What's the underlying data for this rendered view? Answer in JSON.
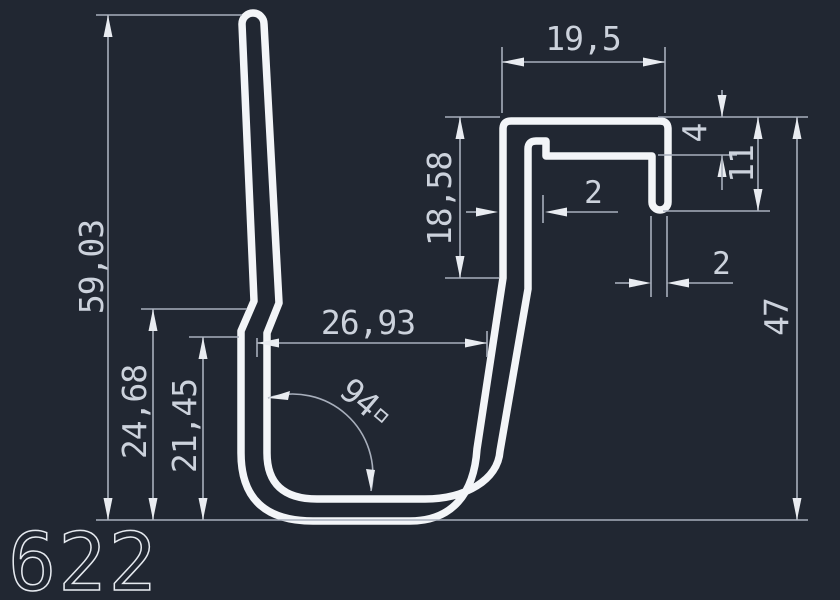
{
  "drawing": {
    "part_label": "622",
    "type": "profile-cross-section"
  },
  "colors": {
    "background": "#212732",
    "profile_stroke": "#f3f5f8",
    "dimension_lines": "#a8afbc",
    "dimension_text": "#ccd2dc",
    "arrowheads": "#e9ecf1"
  },
  "dimensions": {
    "total_height": "59,03",
    "outer_step_height": "24,68",
    "inner_step_height": "21,45",
    "opening_width": "26,93",
    "bottom_angle": "94",
    "hook_depth": "18,58",
    "hook_width": "19,5",
    "ledge_offset": "4",
    "finger_length": "11",
    "wall_thickness": "2",
    "finger_thickness": "2",
    "right_height": "47"
  }
}
